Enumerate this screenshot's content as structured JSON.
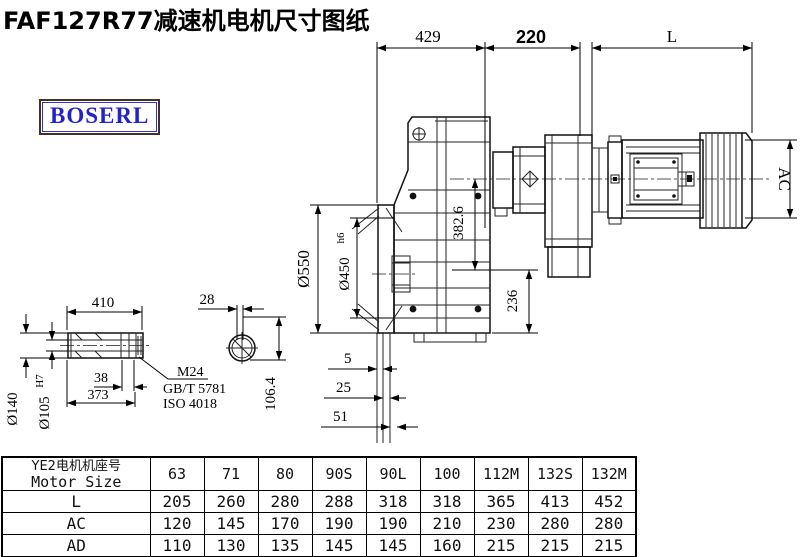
{
  "title": "FAF127R77减速机电机尺寸图纸",
  "brand": "BOSERL",
  "brand_color": "#2323c8",
  "line_color": "#000000",
  "drawing": {
    "dims": {
      "width_429": "429",
      "width_220": "220",
      "motor_length": "L",
      "motor_ac": "AC",
      "height_382_6": "382.6",
      "height_236": "236",
      "flange_od": "Ø550",
      "spigot_d": "Ø450",
      "spigot_tol": "h6",
      "gap_5": "5",
      "gap_25": "25",
      "gap_51": "51",
      "shaft_len": "410",
      "slot_28": "28",
      "plug_38": "38",
      "bore_373": "373",
      "hub_od": "Ø140",
      "hub_bore": "Ø105",
      "hub_bore_tol": "H7",
      "plug_thread": "M24",
      "std_gb": "GB/T 5781",
      "std_iso": "ISO 4018",
      "height_106_4": "106.4"
    }
  },
  "table": {
    "header_cn": "YE2电机机座号",
    "header_en": "Motor Size",
    "columns": [
      "63",
      "71",
      "80",
      "90S",
      "90L",
      "100",
      "112M",
      "132S",
      "132M"
    ],
    "rows": [
      {
        "label": "L",
        "values": [
          "205",
          "260",
          "280",
          "288",
          "318",
          "318",
          "365",
          "413",
          "452"
        ]
      },
      {
        "label": "AC",
        "values": [
          "120",
          "145",
          "170",
          "190",
          "190",
          "210",
          "230",
          "280",
          "280"
        ]
      },
      {
        "label": "AD",
        "values": [
          "110",
          "130",
          "135",
          "145",
          "145",
          "160",
          "215",
          "215",
          "215"
        ]
      }
    ]
  }
}
